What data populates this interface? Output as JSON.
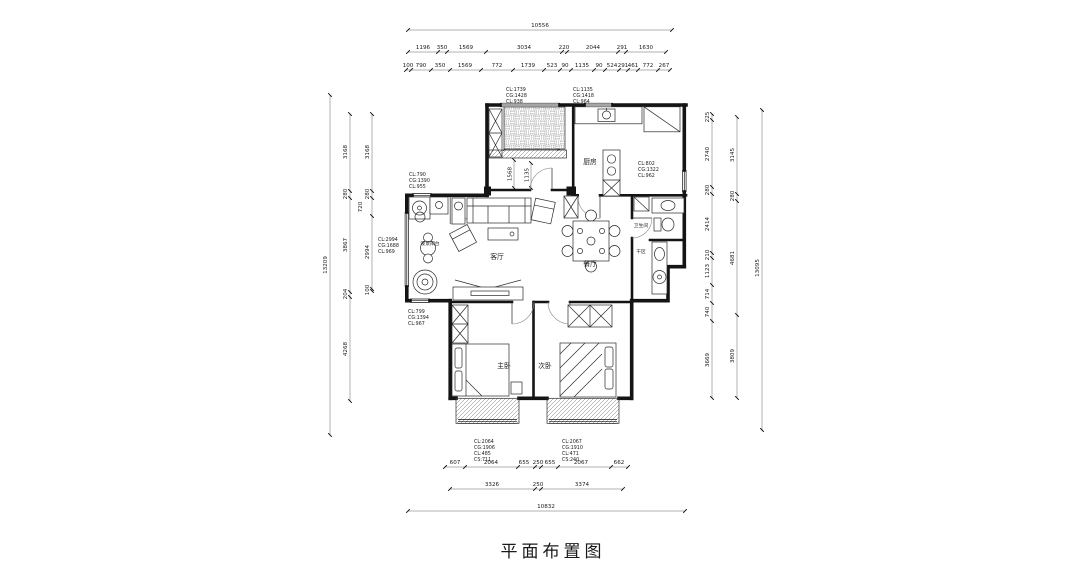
{
  "title": "平面布置图",
  "rooms": {
    "living": "客厅",
    "dining": "餐厅",
    "kitchen": "厨房",
    "bath": "卫生间",
    "dry": "干区",
    "master": "主卧",
    "second": "次卧",
    "bay": "观景阳台"
  },
  "dims": {
    "top_total": "10556",
    "top_row2": [
      "1196",
      "350",
      "1569",
      "3034",
      "220",
      "2044",
      "291",
      "1630"
    ],
    "top_row3": [
      "100",
      "790",
      "350",
      "1569",
      "772",
      "1739",
      "523",
      "90",
      "1135",
      "90",
      "524",
      "291",
      "461",
      "772",
      "267"
    ],
    "bottom_row1": [
      "607",
      "2064",
      "655",
      "250",
      "655",
      "2067",
      "662"
    ],
    "bottom_row2": [
      "3326",
      "250",
      "3374"
    ],
    "bottom_total": "10832",
    "left_total": "13209",
    "left_outer": [
      "3168",
      "280",
      "3867",
      "204",
      "4268"
    ],
    "left_inner": [
      "3168",
      "280",
      "720",
      "2994",
      "100"
    ],
    "right_inner": [
      "225",
      "2740",
      "280",
      "2414",
      "210",
      "1123",
      "714",
      "740",
      "3669"
    ],
    "right_outer": [
      "3145",
      "280",
      "4681",
      "3809"
    ],
    "right_total": "13095",
    "inner": {
      "balcony_w": "2464",
      "balcony_d": "1660",
      "hall_a": "1568",
      "hall_b": "1135"
    }
  },
  "windows": [
    {
      "id": "balcony-top",
      "lines": [
        "CL:1739",
        "CG:1428",
        "CL:938"
      ]
    },
    {
      "id": "kitchen-top",
      "lines": [
        "CL:1135",
        "CG:1418",
        "CL:964"
      ]
    },
    {
      "id": "kitchen-right",
      "lines": [
        "CL:802",
        "CG:1322",
        "CL:962"
      ]
    },
    {
      "id": "entry-left",
      "lines": [
        "CL:790",
        "CG:1390",
        "CL:955"
      ]
    },
    {
      "id": "living-left",
      "lines": [
        "CL:2994",
        "CG:1688",
        "CL:969"
      ]
    },
    {
      "id": "bay-left",
      "lines": [
        "CL:799",
        "CG:1394",
        "CL:967"
      ]
    },
    {
      "id": "master-bottom",
      "lines": [
        "CL:2064",
        "CG:1906",
        "CL:485",
        "CS:711"
      ]
    },
    {
      "id": "second-bottom",
      "lines": [
        "CL:2067",
        "CG:1910",
        "CL:471",
        "CS:240"
      ]
    }
  ],
  "colors": {
    "line": "#1a1a1a",
    "hatch": "#777777",
    "paper": "#ffffff"
  }
}
